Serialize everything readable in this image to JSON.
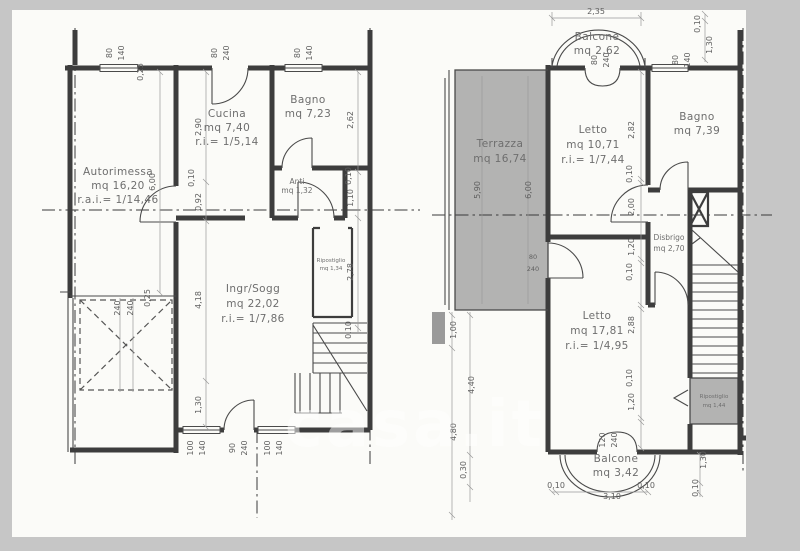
{
  "watermark": {
    "text": "casa.it"
  },
  "palette": {
    "canvas": "#c6c6c6",
    "paper": "#fbfbf8",
    "ink": "#3d3d3d",
    "dim_text": "#5f5f5f",
    "shade": "#a2a2a2",
    "watermark": "#ffffff"
  },
  "plans": {
    "ground": {
      "title": "ground-floor-plan",
      "rooms": [
        {
          "name": "Autorimessa",
          "area": "mq 16,20",
          "ratio": "r.a.i.= 1/14,46"
        },
        {
          "name": "Cucina",
          "area": "mq 7,40",
          "ratio": "r.i.= 1/5,14"
        },
        {
          "name": "Bagno",
          "area": "mq 7,23",
          "ratio": ""
        },
        {
          "name": "Anti",
          "area": "mq 1,32",
          "ratio": ""
        },
        {
          "name": "Ingr/Sogg",
          "area": "mq 22,02",
          "ratio": "r.i.= 1/7,86"
        },
        {
          "name": "Ripostiglio",
          "area": "mq 1,34",
          "ratio": ""
        }
      ],
      "dims": [
        "80",
        "140",
        "0,25",
        "80",
        "240",
        "80",
        "140",
        "6,00",
        "2,90",
        "0,10",
        "0,92",
        "240",
        "240",
        "0,25",
        "4,18",
        "1,30",
        "2,62",
        "0,10",
        "1,10",
        "2,78",
        "0,10",
        "100",
        "140",
        "90",
        "240",
        "100",
        "140"
      ]
    },
    "upper": {
      "title": "first-floor-plan",
      "rooms": [
        {
          "name": "Balcone",
          "area": "mq 2,62",
          "ratio": ""
        },
        {
          "name": "Terrazza",
          "area": "mq 16,74",
          "ratio": ""
        },
        {
          "name": "Letto",
          "area": "mq 10,71",
          "ratio": "r.i.= 1/7,44"
        },
        {
          "name": "Bagno",
          "area": "mq 7,39",
          "ratio": ""
        },
        {
          "name": "Disbrigo",
          "area": "mq 2,70",
          "ratio": ""
        },
        {
          "name": "Letto",
          "area": "mq 17,81",
          "ratio": "r.i.= 1/4,95"
        },
        {
          "name": "Ripostiglio",
          "area": "mq 1,44",
          "ratio": ""
        },
        {
          "name": "Balcone",
          "area": "mq 3,42",
          "ratio": ""
        }
      ],
      "dims": [
        "2,35",
        "0,10",
        "1,30",
        "80",
        "140",
        "80",
        "240",
        "5,90",
        "6,00",
        "80",
        "240",
        "2,82",
        "0,10",
        "2,00",
        "1,20",
        "0,10",
        "2,88",
        "0,10",
        "1,20",
        "1,00",
        "4,40",
        "4,80",
        "0,30",
        "120",
        "240",
        "0,10",
        "3,10",
        "0,10",
        "1,30",
        "0,10"
      ]
    }
  }
}
